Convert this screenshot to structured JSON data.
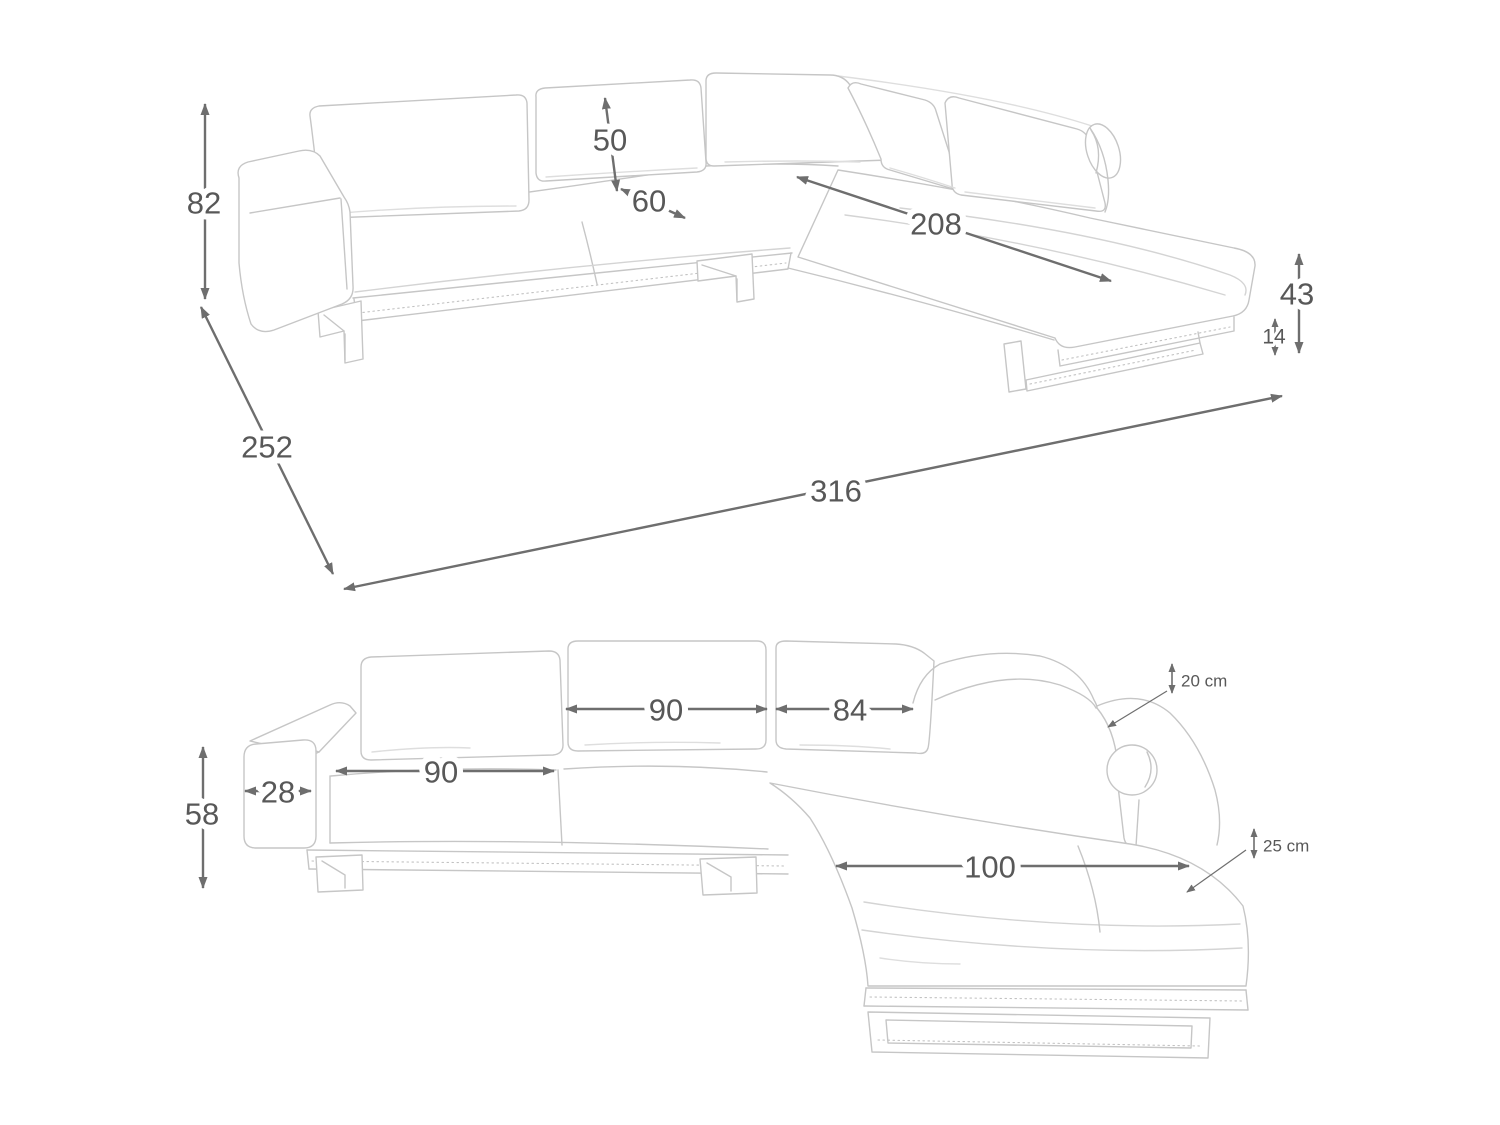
{
  "diagram": {
    "type": "furniture-dimension-drawing",
    "subject": "corner-sofa-with-chaise",
    "colors": {
      "dim_line": "#6e6e6e",
      "dim_text": "#585858",
      "art_line": "#c6c6c6"
    }
  },
  "dimensions": {
    "top_view": [
      {
        "name": "dim-total-height-82",
        "label": "82",
        "x1": 205,
        "y1": 104,
        "x2": 205,
        "y2": 299,
        "lx": 204,
        "ly": 203,
        "fs": 31
      },
      {
        "name": "dim-back-cushion-height-50",
        "label": "50",
        "x1": 605,
        "y1": 98,
        "x2": 617,
        "y2": 191,
        "lx": 610,
        "ly": 140,
        "fs": 31
      },
      {
        "name": "dim-seat-depth-60",
        "label": "60",
        "x1": 621,
        "y1": 189,
        "x2": 685,
        "y2": 218,
        "lx": 649,
        "ly": 201,
        "fs": 31
      },
      {
        "name": "dim-chaise-length-208",
        "label": "208",
        "x1": 797,
        "y1": 177,
        "x2": 1111,
        "y2": 281,
        "lx": 936,
        "ly": 224,
        "fs": 31
      },
      {
        "name": "dim-total-depth-252",
        "label": "252",
        "x1": 201,
        "y1": 307,
        "x2": 333,
        "y2": 574,
        "lx": 267,
        "ly": 447,
        "fs": 31
      },
      {
        "name": "dim-total-width-316",
        "label": "316",
        "x1": 344,
        "y1": 589,
        "x2": 1282,
        "y2": 396,
        "lx": 836,
        "ly": 491,
        "fs": 31
      },
      {
        "name": "dim-seat-height-43",
        "label": "43",
        "x1": 1299,
        "y1": 254,
        "x2": 1299,
        "y2": 353,
        "lx": 1297,
        "ly": 294,
        "fs": 31
      },
      {
        "name": "dim-base-clearance-14",
        "label": "14",
        "x1": 1275,
        "y1": 319,
        "x2": 1275,
        "y2": 355,
        "lx": 1274,
        "ly": 337,
        "fs": 21,
        "small": true
      }
    ],
    "front_view": [
      {
        "name": "dim-arm-height-58",
        "label": "58",
        "x1": 203,
        "y1": 747,
        "x2": 203,
        "y2": 888,
        "lx": 202,
        "ly": 814,
        "fs": 31
      },
      {
        "name": "dim-arm-width-28",
        "label": "28",
        "x1": 245,
        "y1": 791,
        "x2": 311,
        "y2": 791,
        "lx": 278,
        "ly": 792,
        "fs": 31
      },
      {
        "name": "dim-seat-cushion-width-90",
        "label": "90",
        "x1": 336,
        "y1": 771,
        "x2": 554,
        "y2": 771,
        "lx": 441,
        "ly": 772,
        "fs": 31
      },
      {
        "name": "dim-back-cushion-width-90",
        "label": "90",
        "x1": 566,
        "y1": 709,
        "x2": 767,
        "y2": 709,
        "lx": 666,
        "ly": 710,
        "fs": 31
      },
      {
        "name": "dim-back-cushion-width-84",
        "label": "84",
        "x1": 776,
        "y1": 709,
        "x2": 913,
        "y2": 709,
        "lx": 850,
        "ly": 710,
        "fs": 31
      },
      {
        "name": "dim-chaise-width-100",
        "label": "100",
        "x1": 836,
        "y1": 866,
        "x2": 1189,
        "y2": 866,
        "lx": 990,
        "ly": 867,
        "fs": 31
      },
      {
        "name": "dim-back-cushion-thickness-20cm",
        "label": "20 cm",
        "x1": 1172,
        "y1": 664,
        "x2": 1172,
        "y2": 693,
        "lx": 1181,
        "ly": 681,
        "fs": 17,
        "small": true,
        "anchor": "start",
        "leader": [
          1167,
          691,
          1108,
          727
        ]
      },
      {
        "name": "dim-seat-cushion-thickness-25cm",
        "label": "25 cm",
        "x1": 1254,
        "y1": 829,
        "x2": 1254,
        "y2": 858,
        "lx": 1263,
        "ly": 846,
        "fs": 17,
        "small": true,
        "anchor": "start",
        "leader": [
          1246,
          850,
          1187,
          892
        ]
      }
    ]
  }
}
